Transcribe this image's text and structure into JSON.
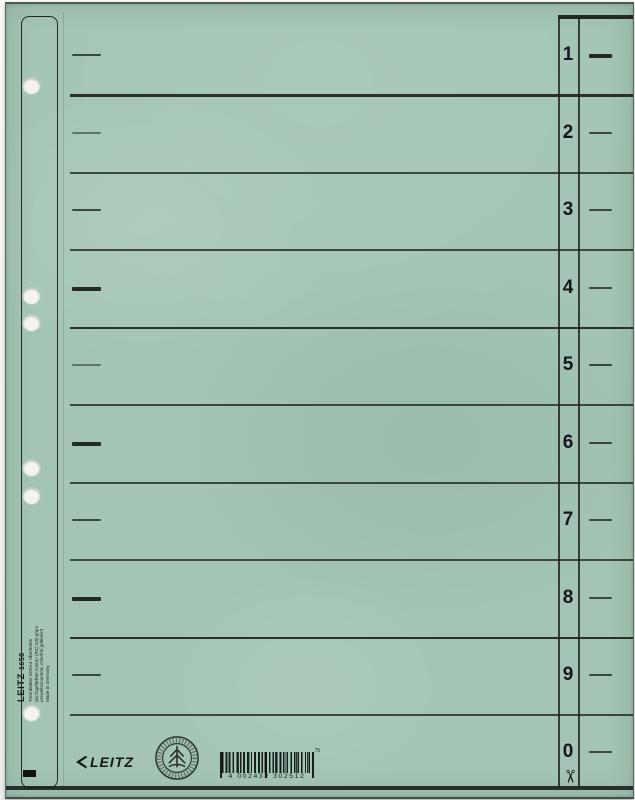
{
  "sheet": {
    "base_color": "#a4c5b5",
    "print_color": "#1c211d",
    "description": "Leitz 1658 cardboard divider sheet, numbered tabs 1-0"
  },
  "punch_margin": {
    "holes_y": [
      82,
      292,
      319,
      464,
      492,
      709
    ],
    "imprint": {
      "brand": "LEITZ",
      "model": "1658",
      "details": [
        "Trennblätter DIN A4 Überbreite",
        "durchgefärbter Karton (RC) 200 g/qm",
        "umweltschonend, chlorfrei gebleicht",
        "Made in Germany"
      ]
    }
  },
  "index_rows": [
    {
      "label": "1",
      "y": 51,
      "left_dash": "normal",
      "right_dash": "bold"
    },
    {
      "label": "2",
      "y": 129,
      "left_dash": "faint",
      "right_dash": "normal"
    },
    {
      "label": "3",
      "y": 206,
      "left_dash": "normal",
      "right_dash": "normal"
    },
    {
      "label": "4",
      "y": 284,
      "left_dash": "bold",
      "right_dash": "normal"
    },
    {
      "label": "5",
      "y": 361,
      "left_dash": "faint",
      "right_dash": "normal"
    },
    {
      "label": "6",
      "y": 439,
      "left_dash": "bold",
      "right_dash": "normal"
    },
    {
      "label": "7",
      "y": 516,
      "left_dash": "normal",
      "right_dash": "normal"
    },
    {
      "label": "8",
      "y": 594,
      "left_dash": "bold",
      "right_dash": "normal"
    },
    {
      "label": "9",
      "y": 671,
      "left_dash": "normal",
      "right_dash": "normal"
    },
    {
      "label": "0",
      "y": 748,
      "left_dash": "none",
      "right_dash": "normal"
    }
  ],
  "separators": [
    {
      "y": 90,
      "weight": "bold"
    },
    {
      "y": 167.5,
      "weight": "normal"
    },
    {
      "y": 245,
      "weight": "normal"
    },
    {
      "y": 322.5,
      "weight": "bold"
    },
    {
      "y": 400,
      "weight": "normal"
    },
    {
      "y": 477.5,
      "weight": "normal"
    },
    {
      "y": 555,
      "weight": "normal"
    },
    {
      "y": 632.5,
      "weight": "bold"
    },
    {
      "y": 710,
      "weight": "normal"
    }
  ],
  "footer": {
    "logo": "LEITZ",
    "stamp_name": "recycled-paper-seal",
    "barcode_digits": "4 002432 302512",
    "barcode_mark": "75"
  },
  "glyphs": {
    "scissors": "✂"
  }
}
